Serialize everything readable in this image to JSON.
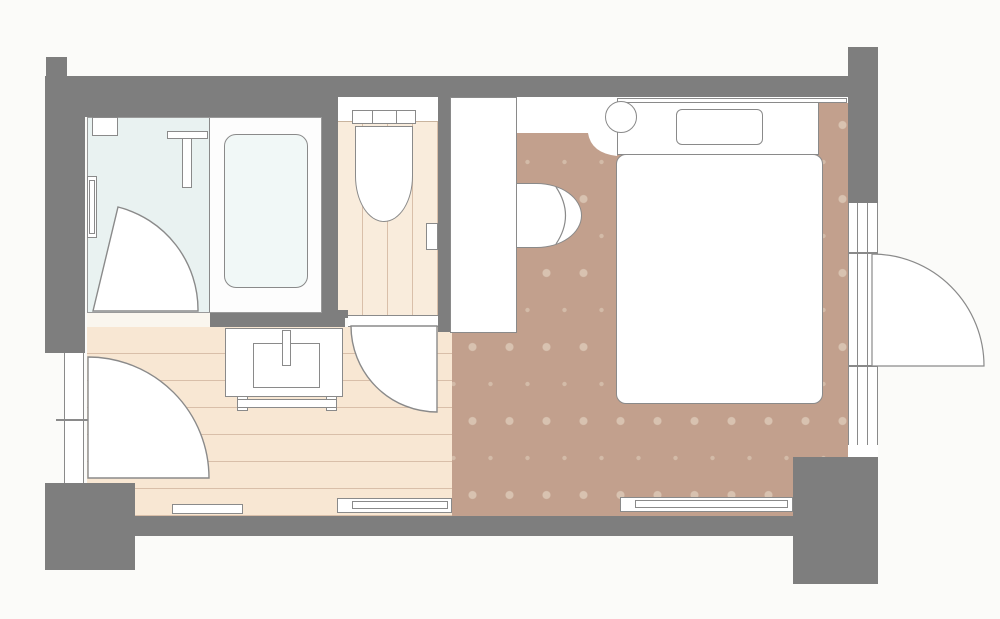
{
  "title": "hotel-room-floor-plan",
  "palette": {
    "bg": "#fbfbf9",
    "wall": "#7e7e7e",
    "line": "#8a8a8a",
    "bath-floor": "#e9f2f1",
    "tub": "#f1f8f7",
    "wood": "#f8e7d3",
    "toilet-floor": "#f9ecdc",
    "wood-line": "#d9bfa9",
    "carpet": "#c2a08d",
    "dot-large": "#d8c2b0",
    "dot-small": "#d3bba8",
    "white": "#ffffff"
  },
  "rooms": {
    "bathroom": "unit-bath",
    "toilet": "toilet-room",
    "washroom": "washroom-entry",
    "bedroom": "bedroom"
  },
  "furniture": [
    "bathtub",
    "shower-counter",
    "grab-bar",
    "bath-shelf",
    "bath-door",
    "toilet",
    "toilet-paper-holder",
    "toilet-door",
    "vanity-sink",
    "faucet",
    "towel-rail",
    "entry-door",
    "closet",
    "luggage-chair",
    "stool",
    "bed",
    "pillow",
    "headboard-shelf",
    "window-balcony-door",
    "floor-board-left",
    "floor-board-center",
    "floor-board-bedroom"
  ]
}
